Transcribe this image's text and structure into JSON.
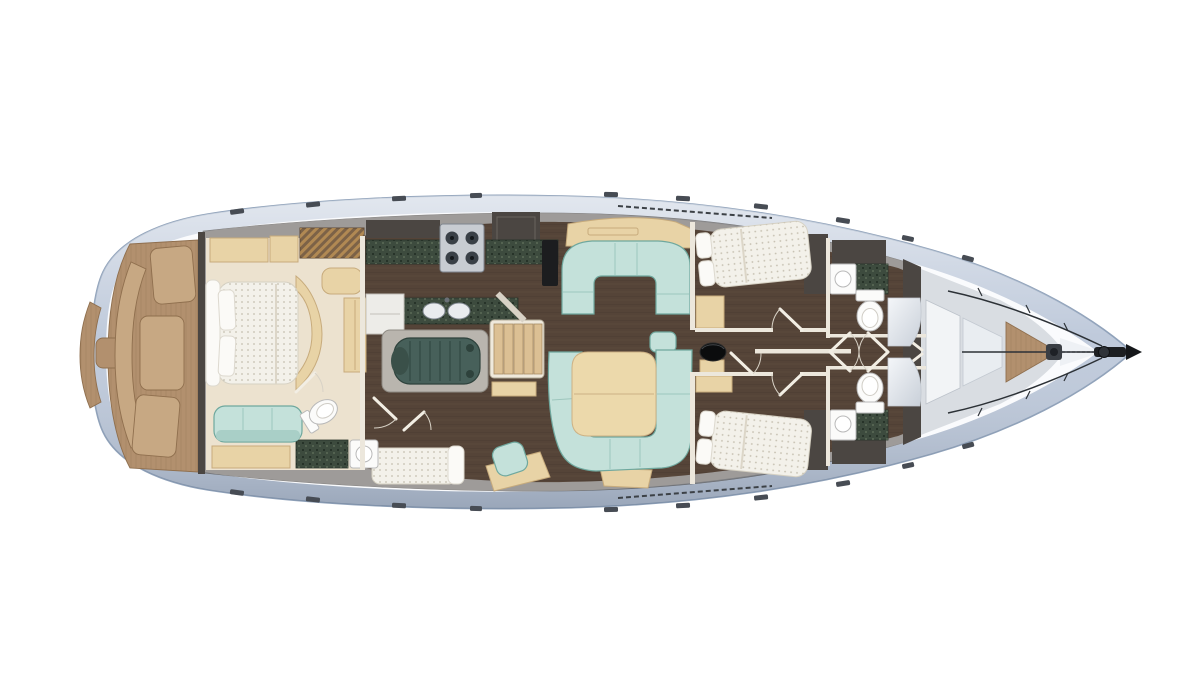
{
  "meta": {
    "type": "yacht-interior-floor-plan",
    "view": "overhead-top-view",
    "orientation": "bow-right-stern-left"
  },
  "colors": {
    "page_bg": "#ffffff",
    "hull_rim": "#bfcadb",
    "hull_rim_edge": "#90a2ba",
    "deck": "#fafbfd",
    "deck_tip_wedge": "#eef1f5",
    "wall": "#625d58",
    "wall_dark": "#4b4642",
    "bulkhead_light": "#ece7dc",
    "teak": "#b2906e",
    "teak_light": "#c7a883",
    "floor": "#554438",
    "cream": "#ece2cf",
    "beige": "#e8d3a6",
    "mattress": "#f3f1ea",
    "pillow": "#fbfaf7",
    "teal": "#c4e1da",
    "teal_shade": "#a9cfc7",
    "counter_green": "#3d4b3e",
    "engine": "#47605a",
    "engine_plate": "#b9b5ae",
    "stair": "#dcc094",
    "stair_frame": "#efe9dc",
    "table": "#ecd9ab",
    "fixture": "#fbfbfa",
    "appliance": "#c8ccd2",
    "appliance_white": "#edece8",
    "dark_equipment": "#1c1d1f",
    "mast": "#0b0c0d",
    "deck_fitting": "#474c54",
    "locker_panel": "#f2f4f6",
    "locker_shadow": "#d9dde2",
    "louver": "#7c6247",
    "bow_metal": "#1d1f22"
  },
  "parts": [
    "hull",
    "side-deck",
    "swim-platform",
    "cockpit",
    "cockpit-bench",
    "helm-seat",
    "owner-cabin",
    "owner-bed",
    "owner-sofa",
    "wardrobe",
    "vanity",
    "aft-head",
    "toilet",
    "shower",
    "washbasin",
    "galley",
    "stove",
    "galley-sink",
    "refrigerator",
    "engine-room",
    "engine",
    "companionway-stairs",
    "single-berth-cabin",
    "single-berth",
    "nav-station",
    "saloon",
    "dinette-settee",
    "saloon-sofa",
    "saloon-table",
    "sideboard",
    "mast",
    "corridor",
    "guest-cabin-port",
    "guest-cabin-starboard",
    "guest-bed",
    "head-port",
    "head-starboard",
    "shower-cabin",
    "forepeak-bulkhead",
    "sail-locker",
    "anchor-locker",
    "windlass",
    "bow-roller",
    "forestay",
    "pulpit",
    "deck-hatch",
    "genoa-track"
  ]
}
